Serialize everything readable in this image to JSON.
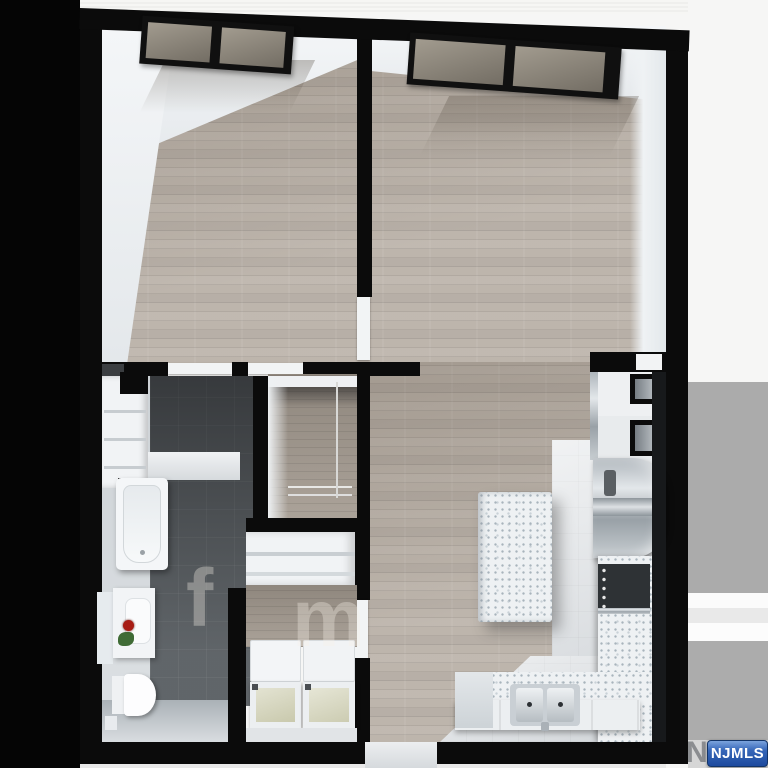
{
  "image": {
    "description": "3D rendered top-down floor plan of a one-bedroom apartment",
    "style": "3d-render, black walls, wood flooring"
  },
  "watermark": {
    "label": "NJMLS",
    "ghost_letter": "N",
    "badge_color": "#2b5cb0",
    "text_color": "#ffffff"
  },
  "floor_watermark": {
    "letters": [
      "f",
      "m"
    ]
  },
  "rooms": [
    {
      "name": "bedroom",
      "floor": "wood",
      "features": [
        "tilted-windows"
      ]
    },
    {
      "name": "living-room",
      "floor": "wood",
      "features": [
        "tilted-windows",
        "open-kitchen"
      ]
    },
    {
      "name": "bathroom",
      "floor": "dark-tile",
      "fixtures": [
        "bathtub",
        "shelf-niche",
        "vanity-sink",
        "mirror",
        "rose",
        "toilet"
      ]
    },
    {
      "name": "walk-in-closet",
      "floor": "wood",
      "fixtures": [
        "hanging-rods"
      ]
    },
    {
      "name": "linen-closet",
      "fixtures": [
        "shelves"
      ]
    },
    {
      "name": "laundry-closet",
      "fixtures": [
        "washer",
        "dryer"
      ]
    },
    {
      "name": "kitchen",
      "floor": "light-tile",
      "fixtures": [
        "island",
        "l-counter",
        "double-sink",
        "range",
        "refrigerator",
        "wall-cabinets"
      ]
    },
    {
      "name": "hallway",
      "features": [
        "entry-opening"
      ]
    }
  ],
  "palette": {
    "wall": "#0b0b0b",
    "wood_floor": "#b6ada3",
    "dark_tile": "#55595d",
    "light_tile": "#dfe2e5",
    "white_face": "#f0f2f4",
    "margin_black": "#050505",
    "margin_gray": "#ababab",
    "margin_white": "#f6f6f5",
    "granite": "#eef1f3",
    "steel": "#b9c0c6"
  }
}
